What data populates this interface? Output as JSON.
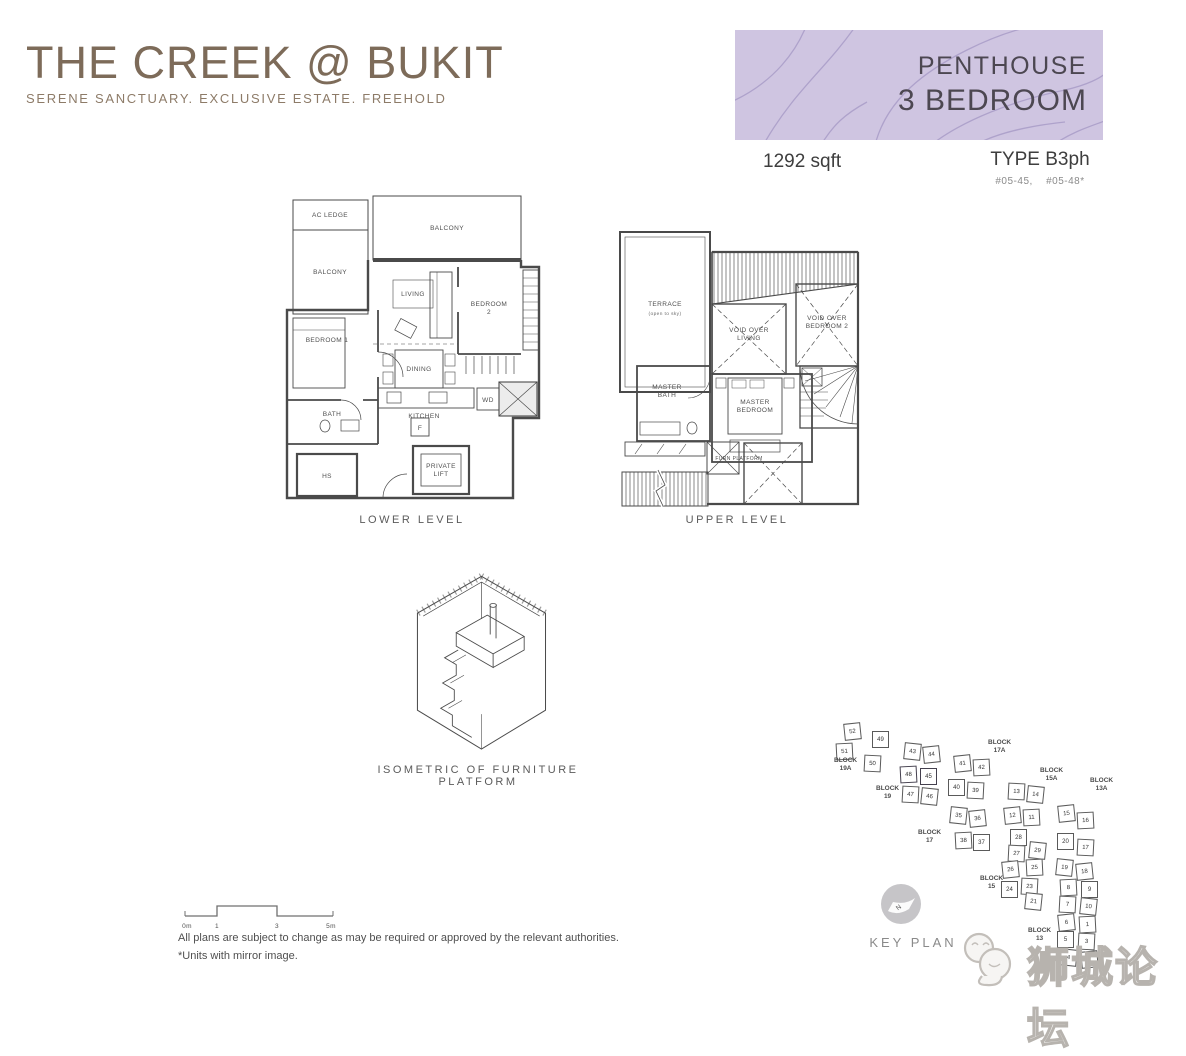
{
  "colors": {
    "banner_bg": "#cfc5e1",
    "banner_contour": "#a79ac6",
    "logo": "#7d6b59",
    "keyplan_highlight": "#a49cb6"
  },
  "header": {
    "logo_title": "THE CREEK @ BUKIT",
    "tagline": "SERENE SANCTUARY. EXCLUSIVE ESTATE. FREEHOLD",
    "banner": {
      "line1": "PENTHOUSE",
      "line2": "3 BEDROOM"
    },
    "area": "1292 sqft",
    "unit_type": "TYPE B3ph",
    "unit_numbers": "#05-45, #05-48*"
  },
  "lower_level": {
    "caption": "LOWER LEVEL",
    "rooms": {
      "ac_ledge": "AC LEDGE",
      "balcony_top": "BALCONY",
      "balcony_left": "BALCONY",
      "bedroom1": "BEDROOM 1",
      "living": "LIVING",
      "bedroom2": [
        "BEDROOM",
        "2"
      ],
      "dining": "DINING",
      "kitchen": "KITCHEN",
      "bath": "BATH",
      "fridge": "F",
      "washer_dryer": "WD",
      "private_lift": [
        "PRIVATE",
        "LIFT"
      ],
      "household_shelter": "HS"
    }
  },
  "upper_level": {
    "caption": "UPPER LEVEL",
    "rooms": {
      "terrace": [
        "TERRACE",
        "(open to sky)"
      ],
      "void_over_living": [
        "VOID OVER",
        "LIVING"
      ],
      "void_over_bedroom2": [
        "VOID OVER",
        "BEDROOM 2"
      ],
      "master_bath": [
        "MASTER",
        "BATH"
      ],
      "master_bedroom": [
        "MASTER",
        "BEDROOM"
      ],
      "furniture_platform": "FURN PLATFORM"
    }
  },
  "isometric": {
    "caption": "ISOMETRIC OF FURNITURE PLATFORM"
  },
  "key_plan": {
    "caption": "KEY PLAN",
    "north_label": "N",
    "blocks": [
      {
        "label": "BLOCK\n19A",
        "x": 14,
        "y": 44
      },
      {
        "label": "BLOCK\n19",
        "x": 56,
        "y": 72
      },
      {
        "label": "BLOCK\n17A",
        "x": 168,
        "y": 26
      },
      {
        "label": "BLOCK\n17",
        "x": 98,
        "y": 116
      },
      {
        "label": "BLOCK\n15A",
        "x": 220,
        "y": 54
      },
      {
        "label": "BLOCK\n15",
        "x": 160,
        "y": 162
      },
      {
        "label": "BLOCK\n13A",
        "x": 270,
        "y": 64
      },
      {
        "label": "BLOCK\n13",
        "x": 208,
        "y": 214
      }
    ],
    "units": [
      {
        "n": "52",
        "x": 24,
        "y": 10
      },
      {
        "n": "51",
        "x": 16,
        "y": 30
      },
      {
        "n": "49",
        "x": 52,
        "y": 18
      },
      {
        "n": "50",
        "x": 44,
        "y": 42
      },
      {
        "n": "43",
        "x": 84,
        "y": 30
      },
      {
        "n": "44",
        "x": 103,
        "y": 33
      },
      {
        "n": "48",
        "x": 80,
        "y": 53,
        "hl": true
      },
      {
        "n": "45",
        "x": 100,
        "y": 55,
        "hl": true
      },
      {
        "n": "47",
        "x": 82,
        "y": 73
      },
      {
        "n": "46",
        "x": 101,
        "y": 75
      },
      {
        "n": "41",
        "x": 134,
        "y": 42
      },
      {
        "n": "42",
        "x": 153,
        "y": 46
      },
      {
        "n": "40",
        "x": 128,
        "y": 66
      },
      {
        "n": "39",
        "x": 147,
        "y": 69
      },
      {
        "n": "35",
        "x": 130,
        "y": 94
      },
      {
        "n": "36",
        "x": 149,
        "y": 97
      },
      {
        "n": "38",
        "x": 135,
        "y": 119
      },
      {
        "n": "37",
        "x": 153,
        "y": 121
      },
      {
        "n": "13",
        "x": 188,
        "y": 70
      },
      {
        "n": "14",
        "x": 207,
        "y": 73
      },
      {
        "n": "12",
        "x": 184,
        "y": 94
      },
      {
        "n": "11",
        "x": 203,
        "y": 96
      },
      {
        "n": "28",
        "x": 190,
        "y": 116
      },
      {
        "n": "27",
        "x": 188,
        "y": 132
      },
      {
        "n": "29",
        "x": 209,
        "y": 129
      },
      {
        "n": "26",
        "x": 182,
        "y": 148
      },
      {
        "n": "25",
        "x": 206,
        "y": 146
      },
      {
        "n": "24",
        "x": 181,
        "y": 168
      },
      {
        "n": "23",
        "x": 201,
        "y": 165
      },
      {
        "n": "21",
        "x": 205,
        "y": 180
      },
      {
        "n": "15",
        "x": 238,
        "y": 92
      },
      {
        "n": "16",
        "x": 257,
        "y": 99
      },
      {
        "n": "20",
        "x": 237,
        "y": 120
      },
      {
        "n": "17",
        "x": 257,
        "y": 126
      },
      {
        "n": "19",
        "x": 236,
        "y": 146
      },
      {
        "n": "18",
        "x": 256,
        "y": 150
      },
      {
        "n": "8",
        "x": 240,
        "y": 166
      },
      {
        "n": "9",
        "x": 261,
        "y": 168
      },
      {
        "n": "7",
        "x": 239,
        "y": 183
      },
      {
        "n": "10",
        "x": 260,
        "y": 185
      },
      {
        "n": "6",
        "x": 238,
        "y": 201
      },
      {
        "n": "1",
        "x": 259,
        "y": 203
      },
      {
        "n": "5",
        "x": 237,
        "y": 218
      },
      {
        "n": "3",
        "x": 258,
        "y": 220
      },
      {
        "n": "4",
        "x": 240,
        "y": 236
      },
      {
        "n": "2",
        "x": 261,
        "y": 238
      }
    ]
  },
  "scale_bar": {
    "labels": [
      "0m",
      "1",
      "3",
      "5m"
    ]
  },
  "footer": {
    "disclaimer_line1": "All plans are subject to change as may be required or approved by the relevant authorities.",
    "disclaimer_line2": "*Units with mirror image."
  },
  "watermark": {
    "text": "狮城论坛"
  }
}
